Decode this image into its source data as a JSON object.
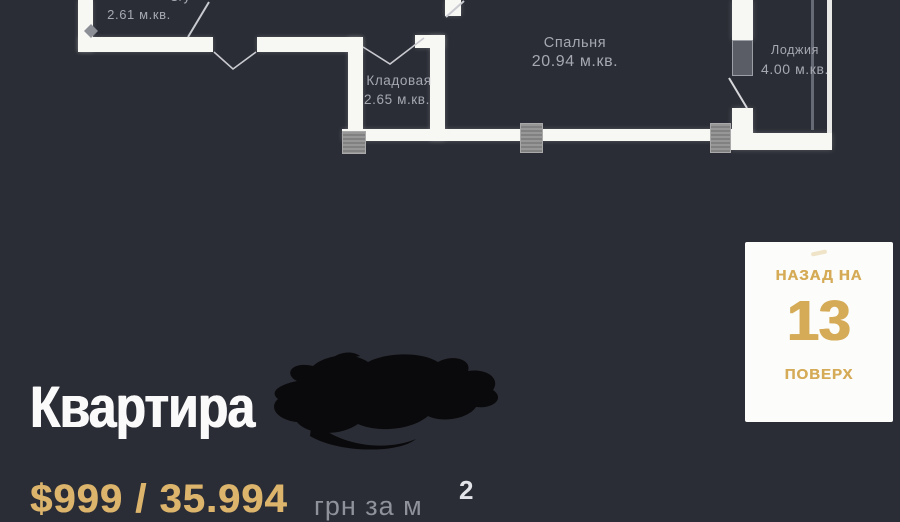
{
  "colors": {
    "background": "#2B2D36",
    "wall": "#F7F7F4",
    "plan_label": "#A6A8B1",
    "pillar_gray": "#8F8F8F",
    "accent_gold": "#DCB46C",
    "card_background": "#FCFCFA",
    "card_text_gold": "#D5AB57",
    "title_white": "#FAFAFA",
    "scribble_black": "#0A0A0C"
  },
  "floorplan": {
    "rooms": {
      "bathroom": {
        "name": "С/у",
        "area": "2.61 м.кв."
      },
      "storage": {
        "name": "Кладовая",
        "area": "2.65 м.кв."
      },
      "bedroom": {
        "name": "Спальня",
        "area": "20.94 м.кв."
      },
      "loggia": {
        "name": "Лоджия",
        "area": "4.00 м.кв."
      }
    }
  },
  "listing": {
    "title": "Квартира",
    "price": "$999 / 35.994",
    "price_unit": "грн за м",
    "price_unit_sup": "2"
  },
  "floor_card": {
    "back_label": "НАЗАД НА",
    "floor_number": "13",
    "floor_label": "ПОВЕРХ"
  }
}
